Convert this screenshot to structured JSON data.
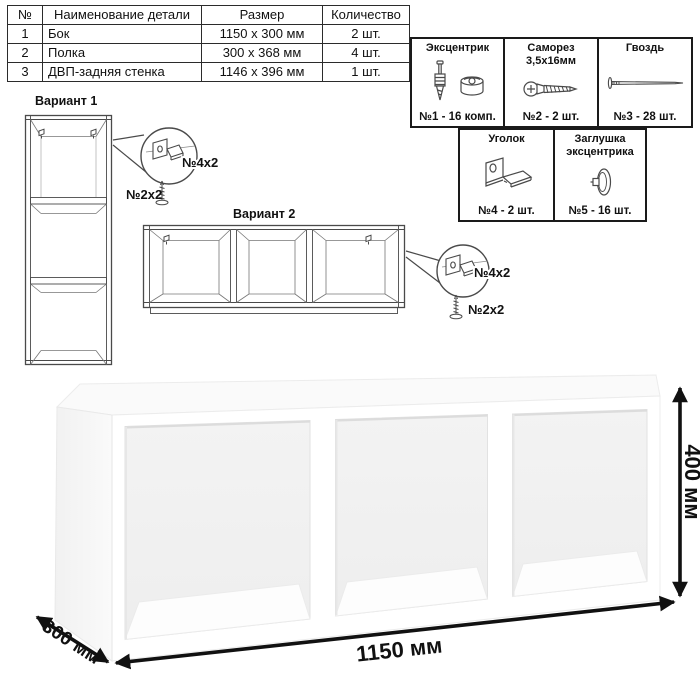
{
  "parts_table": {
    "headers": [
      "№",
      "Наименование детали",
      "Размер",
      "Количество"
    ],
    "rows": [
      {
        "num": "1",
        "name": "Бок",
        "size": "1150 x 300 мм",
        "qty": "2 шт."
      },
      {
        "num": "2",
        "name": "Полка",
        "size": "300 x 368 мм",
        "qty": "4 шт."
      },
      {
        "num": "3",
        "name": "ДВП-задняя стенка",
        "size": "1146 x 396 мм",
        "qty": "1 шт."
      }
    ]
  },
  "hardware_box": {
    "cells": [
      {
        "title": "Эксцентрик",
        "label": "№1 - 16 комп.",
        "icon": "eccentric-fitting-icon"
      },
      {
        "title": "Саморез 3,5х16мм",
        "label": "№2 - 2 шт.",
        "icon": "screw-icon"
      },
      {
        "title": "Гвоздь",
        "label": "№3 - 28 шт.",
        "icon": "nail-icon"
      },
      {
        "title": "Уголок",
        "label": "№4 - 2 шт.",
        "icon": "corner-bracket-icon"
      },
      {
        "title": "Заглушка эксцентрика",
        "label": "№5 - 16 шт.",
        "icon": "eccentric-cap-icon"
      }
    ]
  },
  "variant1": {
    "title": "Вариант 1",
    "callout": {
      "bracket_label": "№4х2",
      "screw_label": "№2х2"
    }
  },
  "variant2": {
    "title": "Вариант 2",
    "callout": {
      "bracket_label": "№4х2",
      "screw_label": "№2х2"
    }
  },
  "dimensions": {
    "width": "1150 мм",
    "height": "400 мм",
    "depth": "300 мм"
  },
  "colors": {
    "line_art": "#4a4a4a",
    "dimension": "#111111",
    "table_border": "#2b2b2b",
    "background": "#ffffff"
  }
}
